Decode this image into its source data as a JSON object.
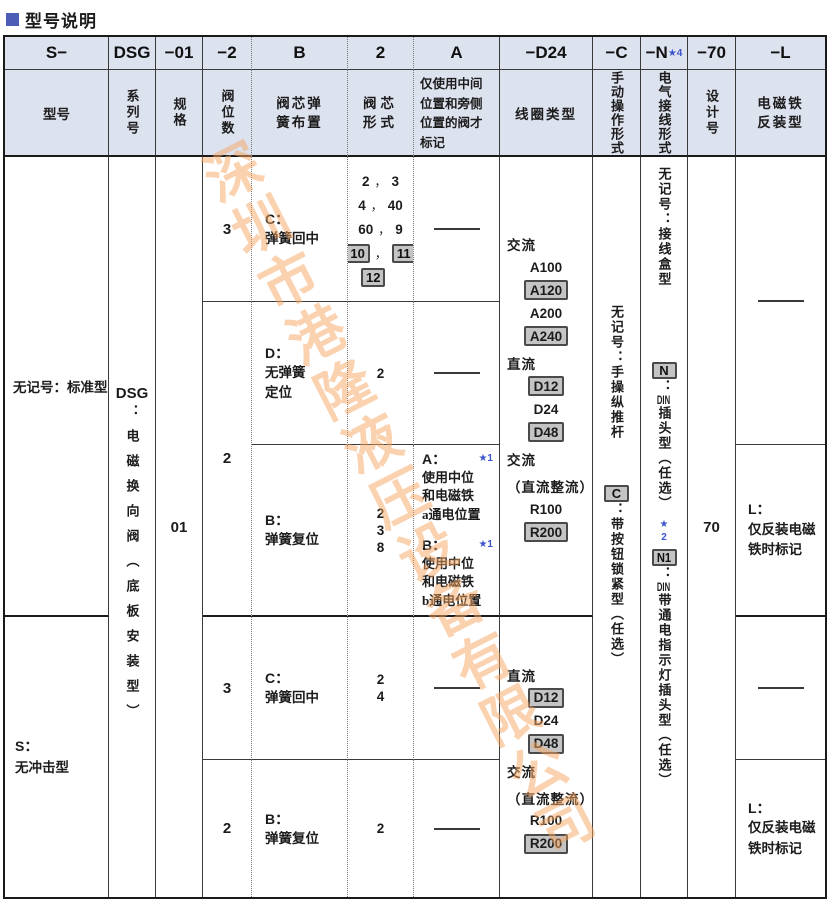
{
  "title": {
    "text": "型号说明"
  },
  "watermark": "深圳市港隆液压设备有限公司",
  "header": {
    "codes": {
      "model": "S−",
      "series": "DSG",
      "size": "−01",
      "positions": "−2",
      "spring": "B",
      "spool": "2",
      "note": "A",
      "coil": "−D24",
      "manual": "−C",
      "electric": "−N",
      "electric_star": "★4",
      "design": "−70",
      "reverse": "−L"
    },
    "labels": {
      "model": "型号",
      "series": "系列号",
      "size": "规格",
      "positions": "阀位数",
      "spring_l1": "阀芯弹",
      "spring_l2": "簧布置",
      "spool_l1": "阀芯",
      "spool_l2": "形式",
      "note_l1": "仅使用中间",
      "note_l2": "位置和旁侧",
      "note_l3": "位置的阀才",
      "note_l4": "标记",
      "coil": "线圈类型",
      "manual": "手动操作形式",
      "electric": "电气接线形式",
      "design": "设计号",
      "reverse_l1": "电磁铁",
      "reverse_l2": "反装型"
    }
  },
  "model": {
    "standard": "无记号：标准型",
    "shockless_code": "S：",
    "shockless_name": "无冲击型"
  },
  "series": {
    "code": "DSG",
    "desc": "：电磁换向阀（底板安装型）"
  },
  "size": "01",
  "design_no": "70",
  "positions": {
    "upper_top": "3",
    "upper_bottom": "2",
    "lower_top": "3",
    "lower_bottom": "2"
  },
  "spring": {
    "c_code": "C：",
    "c_name": "弹簧回中",
    "d_code": "D：",
    "d_name_l1": "无弹簧",
    "d_name_l2": "定位",
    "b_code": "B：",
    "b_name": "弹簧复位"
  },
  "spool": {
    "comma": "，",
    "row1": {
      "a": "2",
      "b": "3",
      "c": "4",
      "d": "40",
      "e": "60",
      "f": "9",
      "g": "10",
      "h": "11",
      "i": "12"
    },
    "row2": "2",
    "row3_a": "2",
    "row3_b": "3",
    "row3_c": "8",
    "row4_a": "2",
    "row4_b": "4",
    "row5": "2"
  },
  "note": {
    "a_code": "A：",
    "a_star": "★1",
    "a_l1": "使用中位",
    "a_l2": "和电磁铁",
    "a_l3": "a通电位置",
    "b_code": "B：",
    "b_star": "★1",
    "b_l1": "使用中位",
    "b_l2": "和电磁铁",
    "b_l3": "b通电位置"
  },
  "coil": {
    "upper": [
      {
        "text": "交流",
        "label": true
      },
      {
        "text": "A100"
      },
      {
        "text": "A120",
        "boxed": true
      },
      {
        "text": "A200"
      },
      {
        "text": "A240",
        "boxed": true
      },
      {
        "text": "直流",
        "label": true
      },
      {
        "text": "D12",
        "boxed": true
      },
      {
        "text": "D24"
      },
      {
        "text": "D48",
        "boxed": true
      },
      {
        "text": "交流",
        "label": true
      },
      {
        "text": "（直流整流）",
        "label": true
      },
      {
        "text": "R100"
      },
      {
        "text": "R200",
        "boxed": true
      }
    ],
    "lower": [
      {
        "text": "直流",
        "label": true
      },
      {
        "text": "D12",
        "boxed": true
      },
      {
        "text": "D24"
      },
      {
        "text": "D48",
        "boxed": true
      },
      {
        "text": "交流",
        "label": true
      },
      {
        "text": "（直流整流）",
        "label": true
      },
      {
        "text": "R100"
      },
      {
        "text": "R200",
        "boxed": true
      }
    ]
  },
  "manual": {
    "none": "无记号：手操纵推杆",
    "c_code": "C",
    "c_desc": "：带按钮锁紧型（任选）"
  },
  "electric": {
    "none": "无记号：接线盒型",
    "n_code": "N",
    "n_colon": "：",
    "n_din": "DIN",
    "n_rest": "插头型（任选）",
    "n1_star": "★2",
    "n1_code": "N1",
    "n1_colon": "：",
    "n1_din": "DIN",
    "n1_rest": "带通电指示灯插头型（任选）"
  },
  "reverse": {
    "l_code": "L：",
    "l_l1": "仅反装电磁",
    "l_l2": "铁时标记"
  }
}
